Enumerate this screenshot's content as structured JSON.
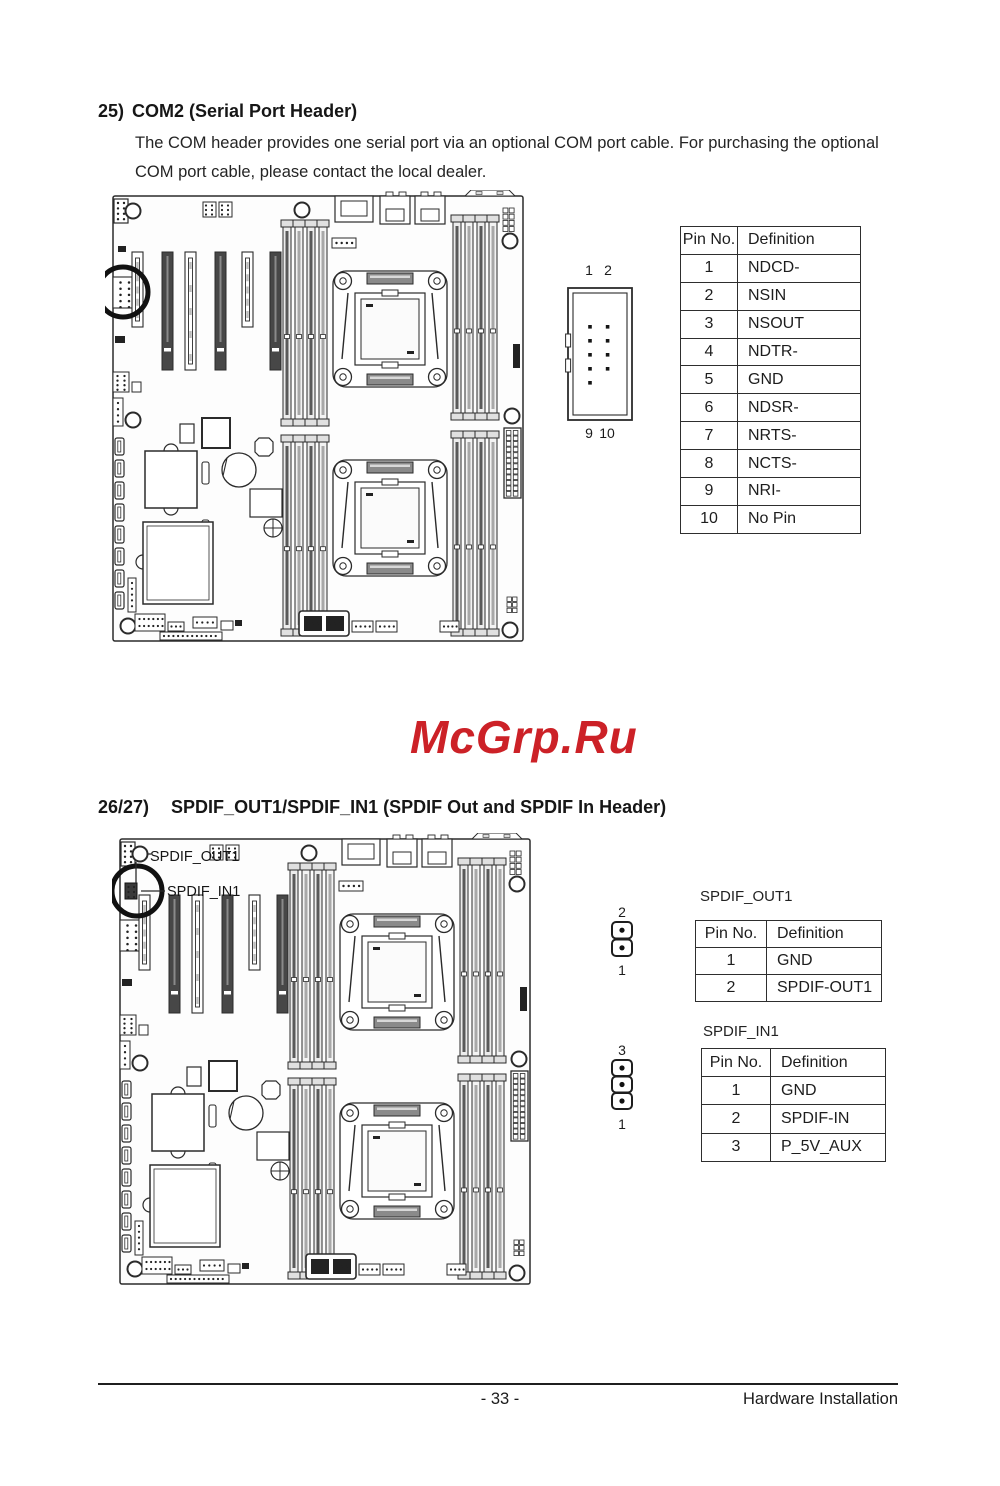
{
  "com2_section": {
    "heading_num": "25)",
    "heading_title": "COM2 (Serial Port Header)",
    "body_lines": [
      "The COM header provides one serial port via an optional COM port cable. For purchasing the optional",
      "COM port cable, please contact the local dealer."
    ],
    "connector_pins": {
      "top_left": "1",
      "top_right": "2",
      "bottom_left": "9",
      "bottom_right": "10"
    },
    "pin_table": {
      "headers": [
        "Pin No.",
        "Definition"
      ],
      "rows": [
        [
          "1",
          "NDCD-"
        ],
        [
          "2",
          "NSIN"
        ],
        [
          "3",
          "NSOUT"
        ],
        [
          "4",
          "NDTR-"
        ],
        [
          "5",
          "GND"
        ],
        [
          "6",
          "NDSR-"
        ],
        [
          "7",
          "NRTS-"
        ],
        [
          "8",
          "NCTS-"
        ],
        [
          "9",
          "NRI-"
        ],
        [
          "10",
          "No Pin"
        ]
      ]
    }
  },
  "watermark": {
    "text": "McGrp.Ru",
    "color": "#cc2127"
  },
  "spdif_section": {
    "heading_num": "26/27)",
    "heading_title": "SPDIF_OUT1/SPDIF_IN1 (SPDIF Out and SPDIF In Header)",
    "board_label_out": "SPDIF_OUT1",
    "board_label_in": "SPDIF_IN1",
    "out_header": {
      "title": "SPDIF_OUT1",
      "pin_top": "2",
      "pin_bottom": "1",
      "table": {
        "headers": [
          "Pin No.",
          "Definition"
        ],
        "rows": [
          [
            "1",
            "GND"
          ],
          [
            "2",
            "SPDIF-OUT1"
          ]
        ]
      }
    },
    "in_header": {
      "title": "SPDIF_IN1",
      "pin_top": "3",
      "pin_bottom": "1",
      "table": {
        "headers": [
          "Pin No.",
          "Definition"
        ],
        "rows": [
          [
            "1",
            "GND"
          ],
          [
            "2",
            "SPDIF-IN"
          ],
          [
            "3",
            "P_5V_AUX"
          ]
        ]
      }
    }
  },
  "footer": {
    "page_number": "- 33 -",
    "right_text": "Hardware Installation"
  }
}
